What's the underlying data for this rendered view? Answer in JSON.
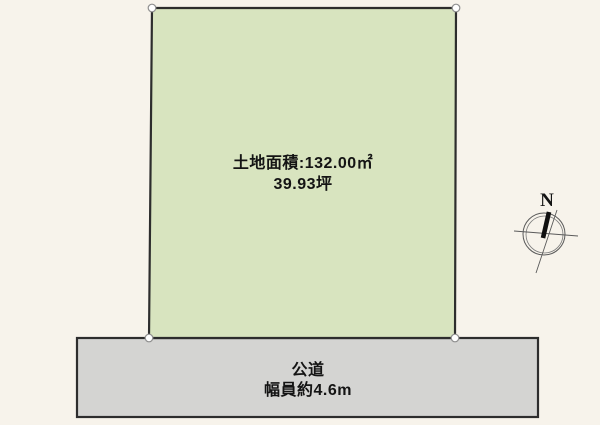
{
  "diagram": {
    "type": "land-plot-layout",
    "colors": {
      "background": "#f7f3eb",
      "land_fill": "#d8e4bf",
      "road_fill": "#d4d4d2",
      "border": "#2d2d2d",
      "marker_fill": "#ffffff",
      "marker_stroke": "#8e8e8e",
      "compass_line": "#4a4a4a",
      "needle": "#101010"
    },
    "land": {
      "area_label": "土地面積:132.00㎡",
      "tsubo_label": "39.93坪"
    },
    "road": {
      "name": "公道",
      "width_label": "幅員約4.6m"
    },
    "compass": {
      "north_label": "N"
    }
  }
}
